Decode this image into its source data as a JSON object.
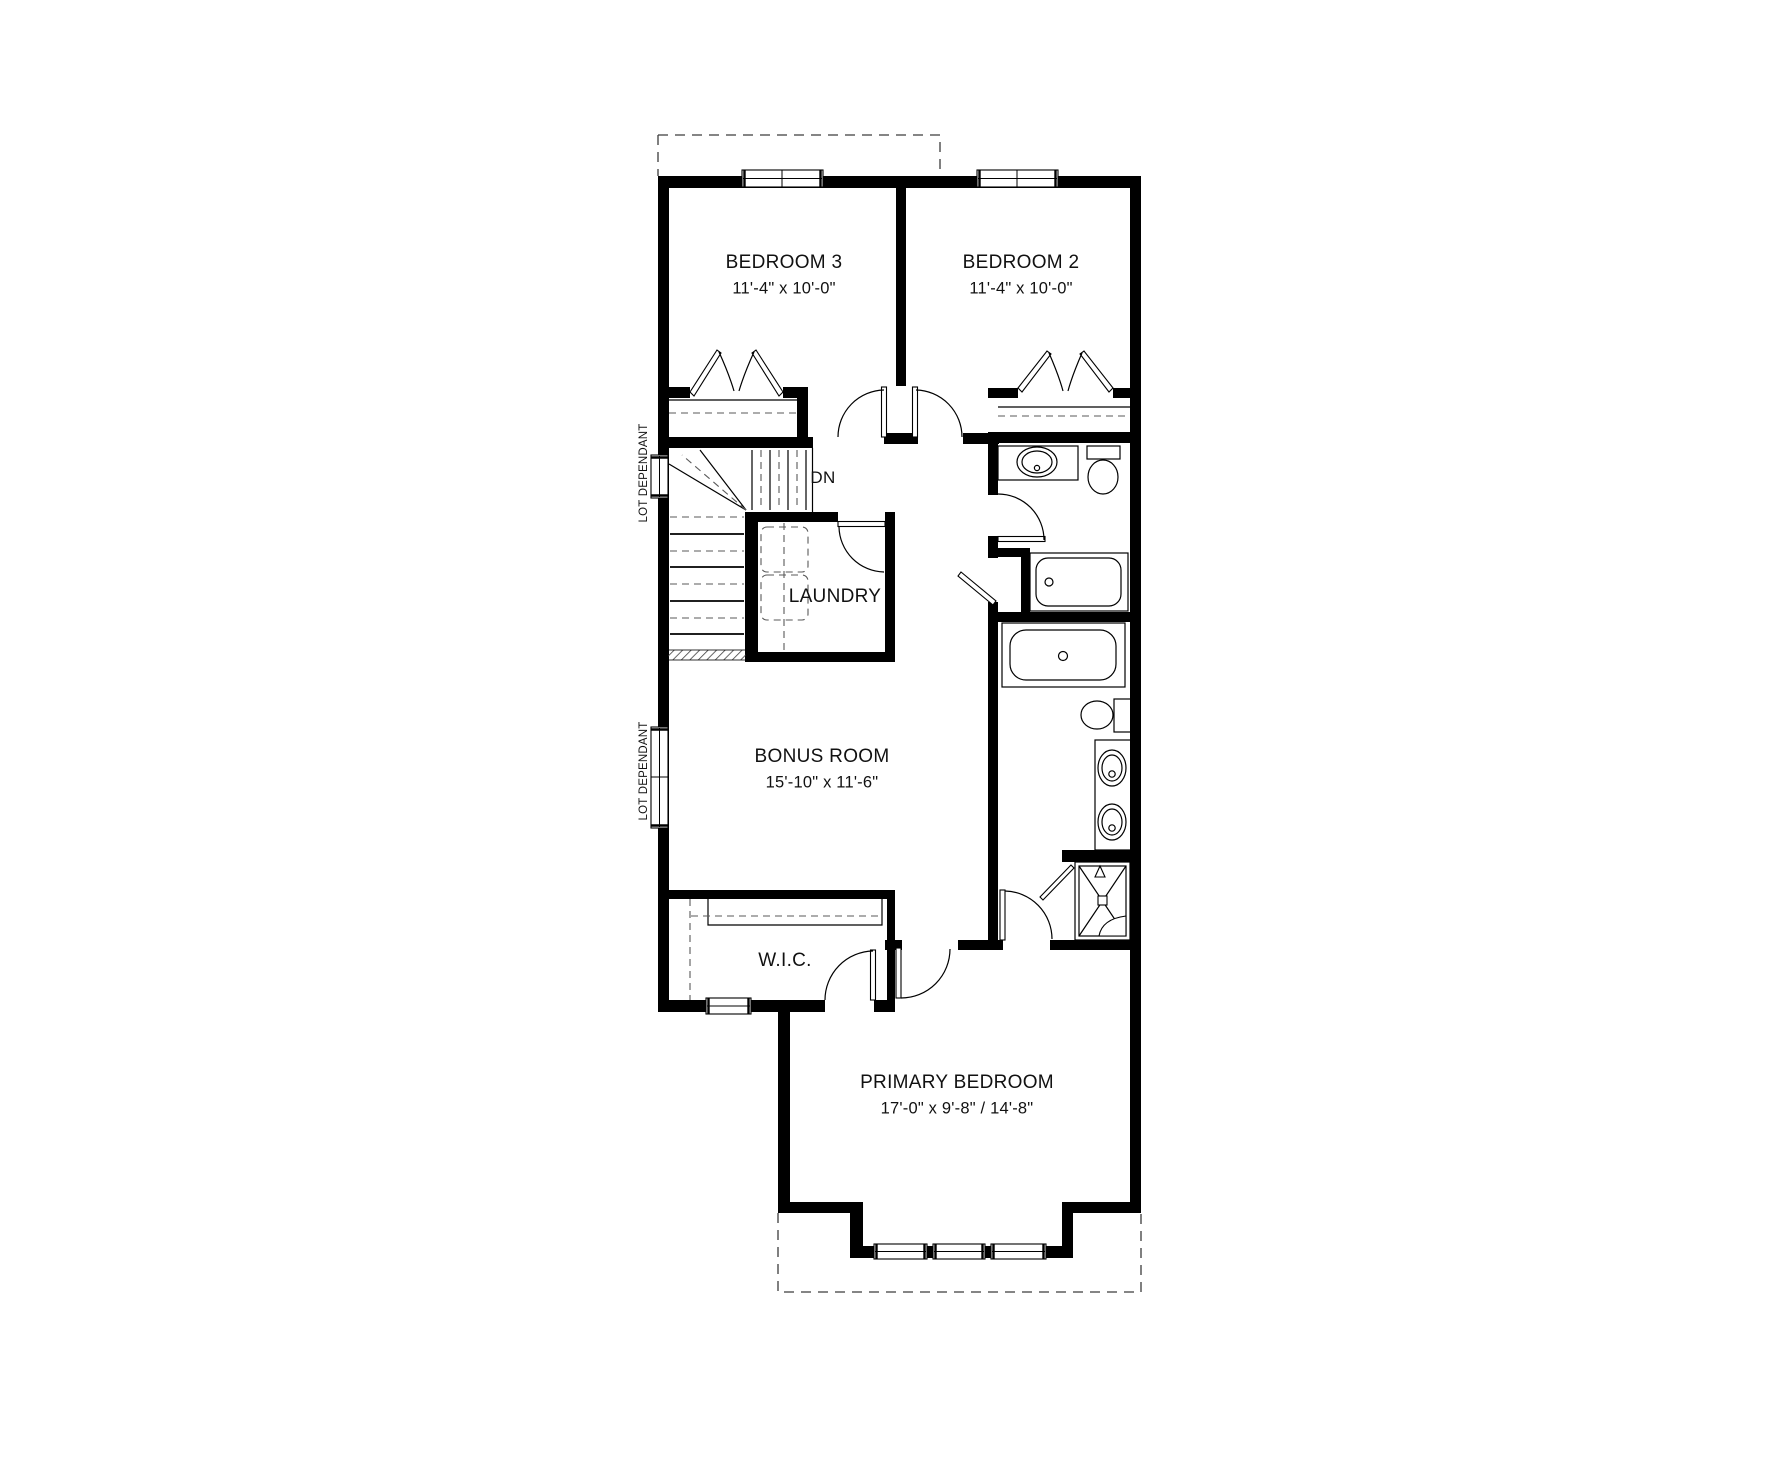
{
  "title": "Second floor plan",
  "rooms": {
    "bedroom3": {
      "name": "BEDROOM 3",
      "dims": "11'-4\" x 10'-0\""
    },
    "bedroom2": {
      "name": "BEDROOM 2",
      "dims": "11'-4\" x 10'-0\""
    },
    "bonus_room": {
      "name": "BONUS ROOM",
      "dims": "15'-10\" x 11'-6\""
    },
    "primary_bedroom": {
      "name": "PRIMARY BEDROOM",
      "dims": "17'-0\" x 9'-8\" / 14'-8\""
    },
    "laundry": {
      "name": "LAUNDRY"
    },
    "wic": {
      "name": "W.I.C."
    }
  },
  "annotations": {
    "stair_direction": "DN",
    "lot_dependant_upper": "LOT DEPENDANT",
    "lot_dependant_lower": "LOT DEPENDANT"
  },
  "fixtures": {
    "main_bath": [
      "vanity-sink",
      "toilet",
      "bathtub",
      "linen-closet"
    ],
    "ensuite": [
      "soaker-tub",
      "toilet",
      "double-vanity-sinks",
      "shower"
    ],
    "laundry": [
      "washer-dryer-stack"
    ]
  },
  "colors": {
    "walls": "#000000",
    "lines": "#1a1a1a",
    "dashed": "#555555",
    "background": "#ffffff"
  }
}
